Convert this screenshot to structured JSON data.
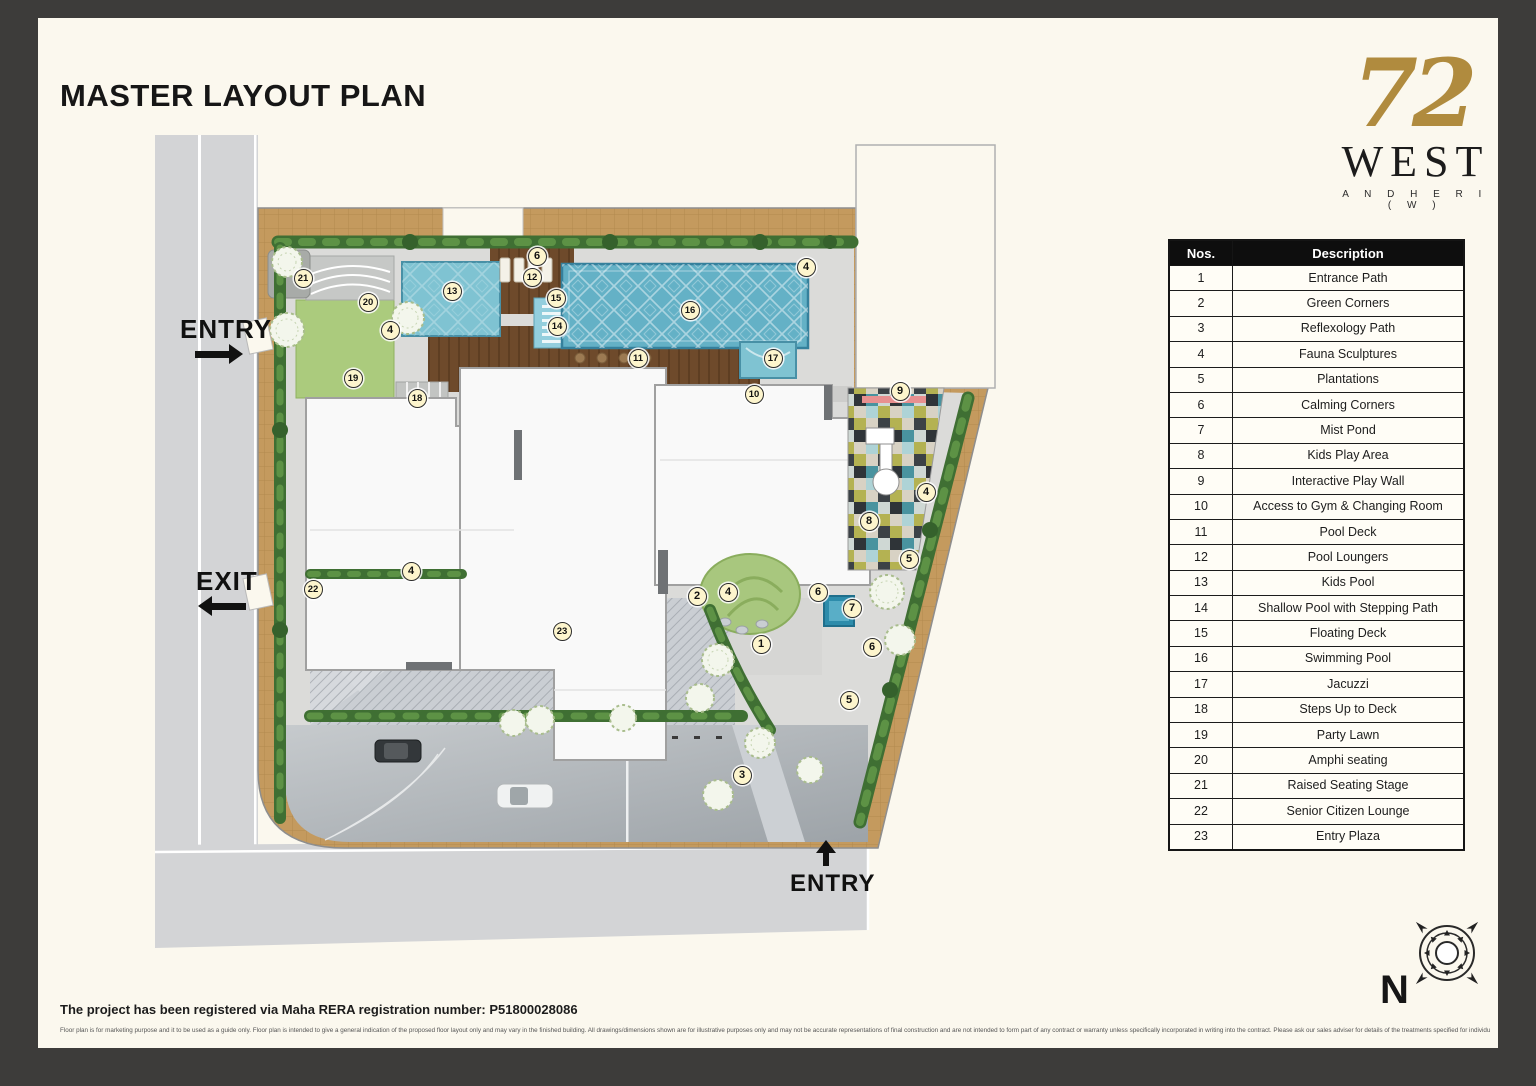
{
  "header": {
    "title": "MASTER LAYOUT PLAN"
  },
  "logo": {
    "number": "72",
    "name": "WEST",
    "location": "A N D H E R I   ( W )",
    "gold_color": "#b08b3e"
  },
  "legend": {
    "headers": {
      "nos": "Nos.",
      "description": "Description"
    },
    "rows": [
      {
        "no": "1",
        "description": "Entrance Path"
      },
      {
        "no": "2",
        "description": "Green Corners"
      },
      {
        "no": "3",
        "description": "Reflexology Path"
      },
      {
        "no": "4",
        "description": "Fauna Sculptures"
      },
      {
        "no": "5",
        "description": "Plantations"
      },
      {
        "no": "6",
        "description": "Calming Corners"
      },
      {
        "no": "7",
        "description": "Mist Pond"
      },
      {
        "no": "8",
        "description": "Kids Play Area"
      },
      {
        "no": "9",
        "description": "Interactive Play Wall"
      },
      {
        "no": "10",
        "description": "Access to Gym & Changing Room"
      },
      {
        "no": "11",
        "description": "Pool Deck"
      },
      {
        "no": "12",
        "description": "Pool Loungers"
      },
      {
        "no": "13",
        "description": "Kids Pool"
      },
      {
        "no": "14",
        "description": "Shallow Pool with Stepping Path"
      },
      {
        "no": "15",
        "description": "Floating Deck"
      },
      {
        "no": "16",
        "description": "Swimming Pool"
      },
      {
        "no": "17",
        "description": "Jacuzzi"
      },
      {
        "no": "18",
        "description": "Steps Up to Deck"
      },
      {
        "no": "19",
        "description": "Party Lawn"
      },
      {
        "no": "20",
        "description": "Amphi seating"
      },
      {
        "no": "21",
        "description": "Raised Seating Stage"
      },
      {
        "no": "22",
        "description": "Senior Citizen Lounge"
      },
      {
        "no": "23",
        "description": "Entry Plaza"
      }
    ]
  },
  "plan": {
    "compass_n": "N",
    "labels": [
      {
        "text": "ENTRY",
        "x": 70,
        "y": 184,
        "size": 26,
        "arrow": {
          "dir": "right",
          "x": 85,
          "y": 214,
          "len": 48
        }
      },
      {
        "text": "EXIT",
        "x": 86,
        "y": 436,
        "size": 26,
        "arrow": {
          "dir": "left",
          "x": 88,
          "y": 466,
          "len": 48
        }
      },
      {
        "text": "ENTRY",
        "x": 680,
        "y": 740,
        "size": 24,
        "arrow": {
          "dir": "up",
          "x": 706,
          "y": 710,
          "len": 26
        }
      }
    ],
    "markers": [
      {
        "n": "21",
        "x": 193,
        "y": 148
      },
      {
        "n": "20",
        "x": 258,
        "y": 172
      },
      {
        "n": "4",
        "x": 280,
        "y": 200
      },
      {
        "n": "13",
        "x": 342,
        "y": 161
      },
      {
        "n": "6",
        "x": 427,
        "y": 126
      },
      {
        "n": "12",
        "x": 422,
        "y": 147
      },
      {
        "n": "15",
        "x": 446,
        "y": 168
      },
      {
        "n": "14",
        "x": 447,
        "y": 196
      },
      {
        "n": "16",
        "x": 580,
        "y": 180
      },
      {
        "n": "4",
        "x": 696,
        "y": 137
      },
      {
        "n": "11",
        "x": 528,
        "y": 228
      },
      {
        "n": "17",
        "x": 663,
        "y": 228
      },
      {
        "n": "10",
        "x": 644,
        "y": 264
      },
      {
        "n": "9",
        "x": 790,
        "y": 261
      },
      {
        "n": "19",
        "x": 243,
        "y": 248
      },
      {
        "n": "18",
        "x": 307,
        "y": 268
      },
      {
        "n": "4",
        "x": 816,
        "y": 362
      },
      {
        "n": "8",
        "x": 759,
        "y": 391
      },
      {
        "n": "5",
        "x": 799,
        "y": 429
      },
      {
        "n": "4",
        "x": 301,
        "y": 441
      },
      {
        "n": "22",
        "x": 203,
        "y": 459
      },
      {
        "n": "2",
        "x": 587,
        "y": 466
      },
      {
        "n": "4",
        "x": 618,
        "y": 462
      },
      {
        "n": "6",
        "x": 708,
        "y": 462
      },
      {
        "n": "7",
        "x": 742,
        "y": 478
      },
      {
        "n": "23",
        "x": 452,
        "y": 501
      },
      {
        "n": "1",
        "x": 651,
        "y": 514
      },
      {
        "n": "6",
        "x": 762,
        "y": 517
      },
      {
        "n": "5",
        "x": 739,
        "y": 570
      },
      {
        "n": "3",
        "x": 632,
        "y": 645
      }
    ]
  },
  "footer": {
    "rera": "The project has been registered via Maha RERA registration number: P51800028086",
    "disclaimer": "Floor plan is for marketing purpose and it to be used as a guide only. Floor plan is intended to give a general indication of the proposed floor layout only and may vary in the finished building. All drawings/dimensions shown are for illustrative purposes only and may not be accurate representations of final construction and are not intended to form part of any contract or warranty unless specifically incorporated in writing into the contract. Please ask our sales adviser for details of the treatments specified for individual Apartment/Flat/Premises/Shop."
  }
}
